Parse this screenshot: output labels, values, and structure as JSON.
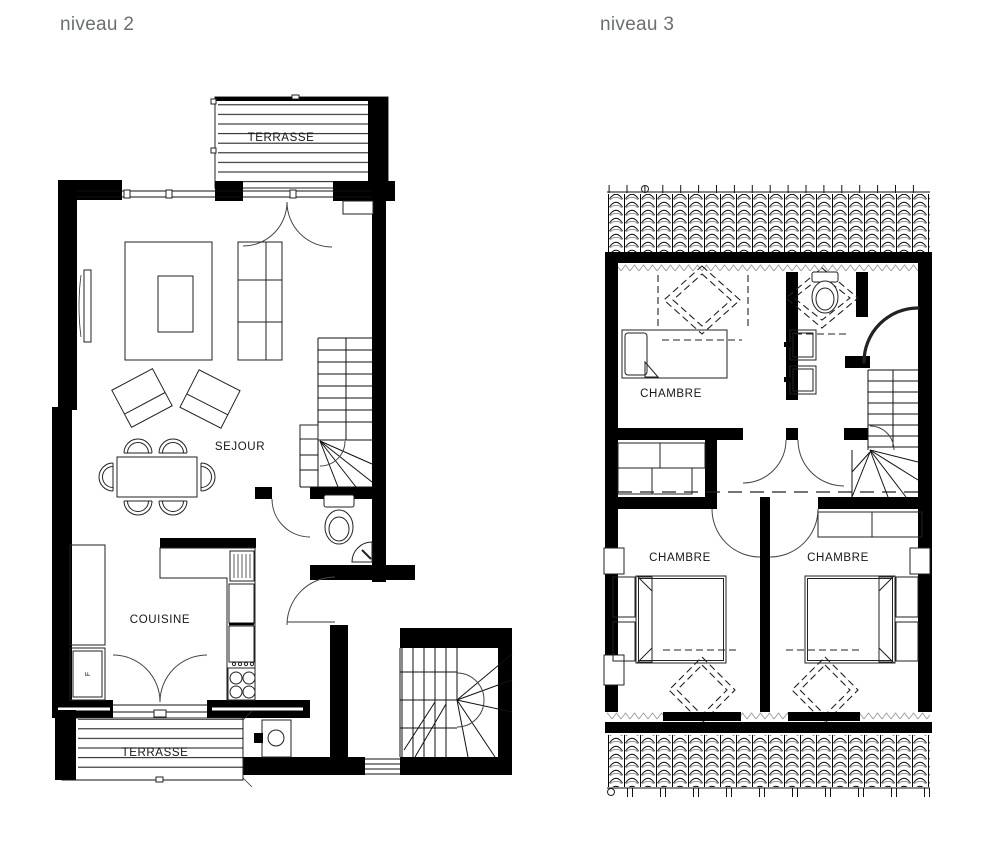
{
  "plans": [
    {
      "title": "niveau 2",
      "rooms": [
        {
          "label": "TERRASSE"
        },
        {
          "label": "SEJOUR"
        },
        {
          "label": "COUISINE"
        },
        {
          "label": "TERRASSE"
        }
      ],
      "appliances": [
        {
          "label": "F"
        }
      ]
    },
    {
      "title": "niveau 3",
      "rooms": [
        {
          "label": "CHAMBRE"
        },
        {
          "label": "CHAMBRE"
        },
        {
          "label": "CHAMBRE"
        }
      ]
    }
  ],
  "colors": {
    "background": "#ffffff",
    "line": "#111111",
    "wall": "#000000",
    "room_label": "#16161c",
    "title": "#6a6f74"
  }
}
